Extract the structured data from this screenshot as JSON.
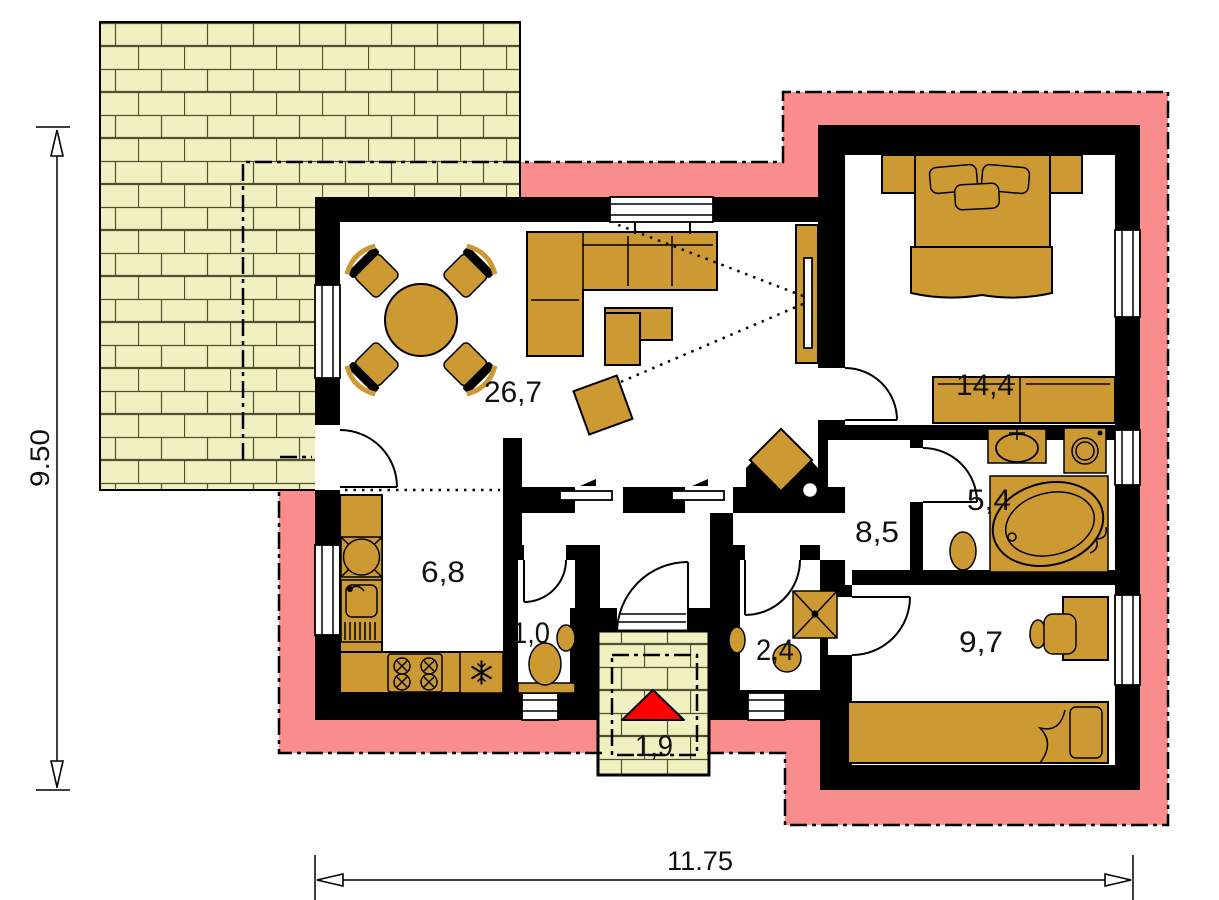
{
  "plan": {
    "rooms": [
      {
        "id": "living-dining",
        "area": "26,7"
      },
      {
        "id": "bedroom-main",
        "area": "14,4"
      },
      {
        "id": "bathroom",
        "area": "5,4"
      },
      {
        "id": "hall",
        "area": "8,5"
      },
      {
        "id": "kitchen",
        "area": "6,8"
      },
      {
        "id": "wc",
        "area": "1,0"
      },
      {
        "id": "utility-room",
        "area": "2,4"
      },
      {
        "id": "bedroom-second",
        "area": "9,7"
      },
      {
        "id": "entry-porch",
        "area": "1,9"
      }
    ],
    "dimensions": {
      "overall_height": "9.50",
      "overall_width": "11.75"
    },
    "colors": {
      "insulation_band": "#F98C8C",
      "terrace_brick": "#F1F0C1",
      "furniture": "#CC9933",
      "walls": "#000000",
      "entry_marker": "#FF0000"
    }
  }
}
